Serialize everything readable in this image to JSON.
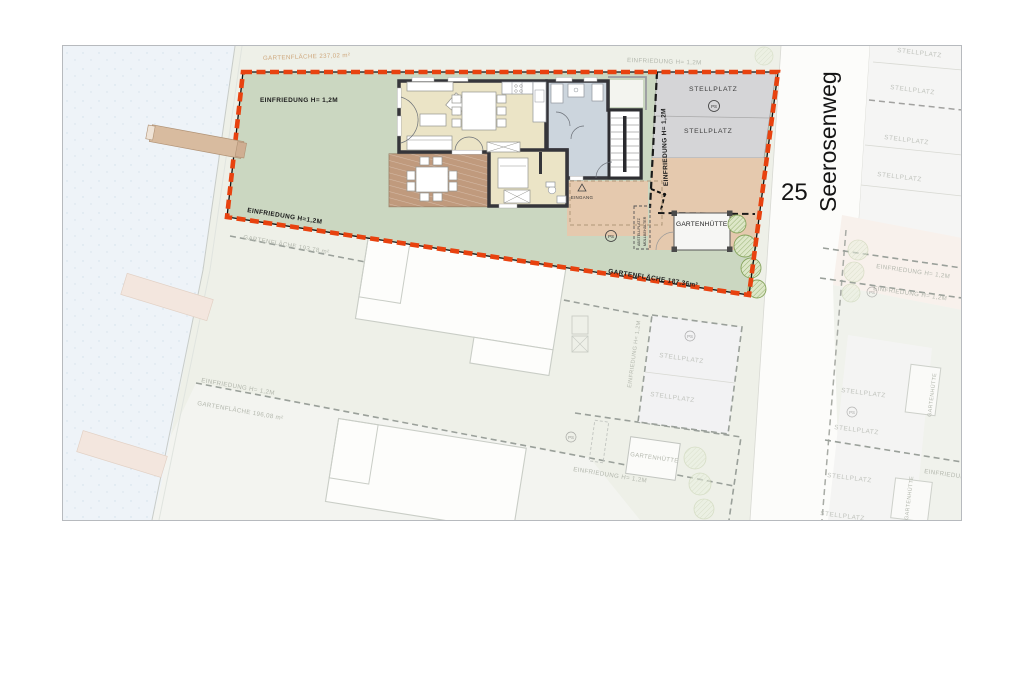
{
  "plan": {
    "title_context": "Site plan with house floor plan",
    "street": {
      "name": "Seerosenweg",
      "house_number": "25"
    },
    "labels": {
      "einfriedung": "EINFRIEDUNG H= 1,2M",
      "einfriedung_compact": "EINFRIEDUNG H=1,2M",
      "garden_area_237": "GARTENFLÄCHE 237,02 m²",
      "garden_area_193": "GARTENFLÄCHE 193,78 m²",
      "garden_area_196": "GARTENFLÄCHE 196,08 m²",
      "garden_area_187": "GARTENFLÄCHE 187,36m²",
      "parking": "STELLPLATZ",
      "garden_shed": "GARTENHÜTTE",
      "entrance": "EINGANG",
      "bin_storage_line1": "ABSTELLPLATZ",
      "bin_storage_line2": "MÜLLBEHÄLTER",
      "parking_symbol": "PS"
    },
    "colors": {
      "boundary_red": "#e8420f",
      "garden_green": "#cbd7c1",
      "parking_gray": "#d5d5d7",
      "driveway_tan": "#e5c9ae",
      "floor_beige": "#ebe4c6",
      "bath_blue": "#ccd5dd",
      "terrace_brown": "#c09a7d",
      "water_blue": "#eef3f8",
      "pier_tan": "#d8bb9f"
    }
  }
}
